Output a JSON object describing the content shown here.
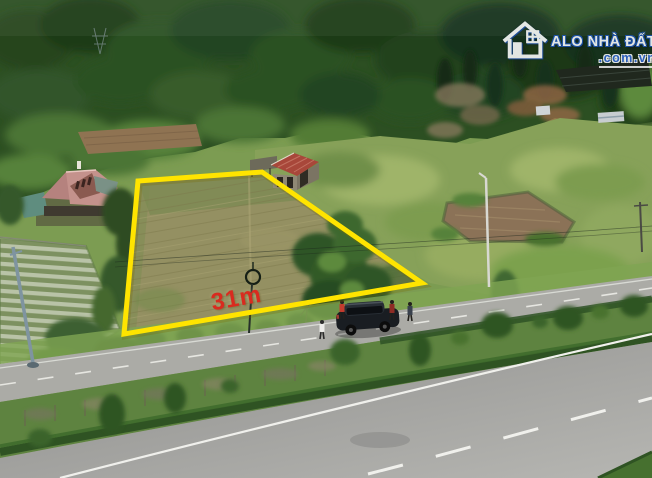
{
  "watermark": {
    "brand": "ALO NHÀ ĐẤT",
    "domain": ".com.vn",
    "icon": "house-outline-icon",
    "brand_color": "#ffffff",
    "accent_color": "#2f66d0"
  },
  "annotations": {
    "dimension_label": "31m",
    "dimension_label_color": "#d92b1f",
    "boundary_color": "#ffe400"
  },
  "scene": {
    "elements": [
      "forested hillside",
      "roadside land plot outlined in yellow",
      "red-roof farm shed",
      "pink-roof house with crop rows",
      "irrigation pond",
      "frontage road with parked black SUV and people",
      "landscaped median with shrubs",
      "main highway with lane markings"
    ],
    "colors": {
      "forest": "#2c4f22",
      "meadow": "#87a159",
      "plot_field": "#949062",
      "pond_water": "#8b7257",
      "frontage_road": "#ababa6",
      "highway": "#9c9c9a",
      "median_grass": "#5e8340",
      "house_roof": "#c4928c",
      "shed_roof": "#a8473a",
      "car_body": "#191d22"
    }
  }
}
